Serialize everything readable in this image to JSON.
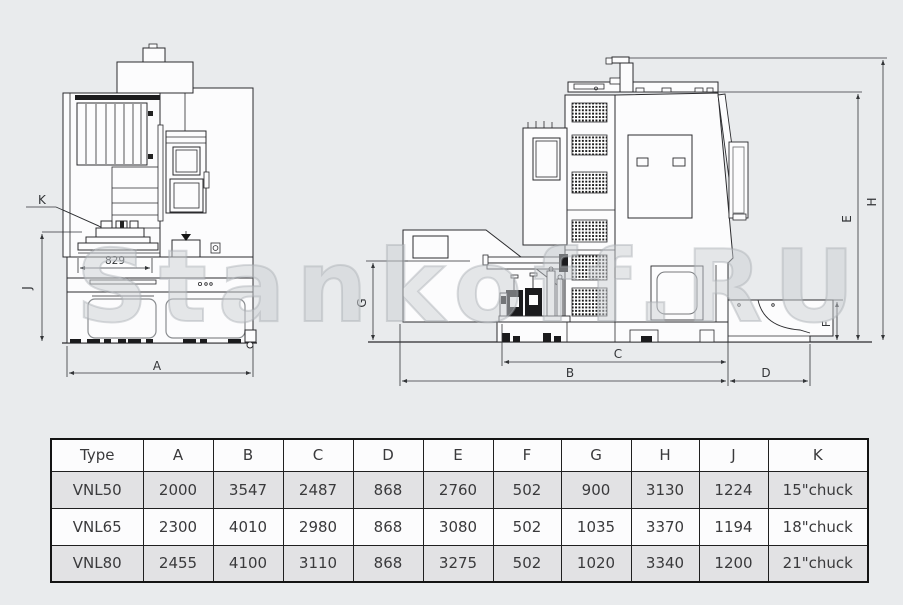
{
  "colors": {
    "background": "#e9ebed",
    "line": "#2b2b2e",
    "dark_fill": "#1b1b1d",
    "table_border": "#141414",
    "table_shaded_row": "#e2e2e4",
    "text": "#3a3a3c",
    "watermark": "#cbcfd4"
  },
  "watermark": {
    "text": "Stankoff.RU"
  },
  "drawing": {
    "front_view": {
      "labels": {
        "K": "K",
        "J": "J",
        "A": "A"
      },
      "dim_829": "829"
    },
    "side_view": {
      "labels": {
        "B": "B",
        "C": "C",
        "D": "D",
        "E": "E",
        "F": "F",
        "G": "G",
        "H": "H"
      }
    }
  },
  "table": {
    "headers": [
      "Type",
      "A",
      "B",
      "C",
      "D",
      "E",
      "F",
      "G",
      "H",
      "J",
      "K"
    ],
    "col_widths": [
      92,
      70,
      70,
      70,
      70,
      70,
      68,
      70,
      68,
      69,
      100
    ],
    "rows": [
      [
        "VNL50",
        "2000",
        "3547",
        "2487",
        "868",
        "2760",
        "502",
        "900",
        "3130",
        "1224",
        "15\"chuck"
      ],
      [
        "VNL65",
        "2300",
        "4010",
        "2980",
        "868",
        "3080",
        "502",
        "1035",
        "3370",
        "1194",
        "18\"chuck"
      ],
      [
        "VNL80",
        "2455",
        "4100",
        "3110",
        "868",
        "3275",
        "502",
        "1020",
        "3340",
        "1200",
        "21\"chuck"
      ]
    ]
  }
}
